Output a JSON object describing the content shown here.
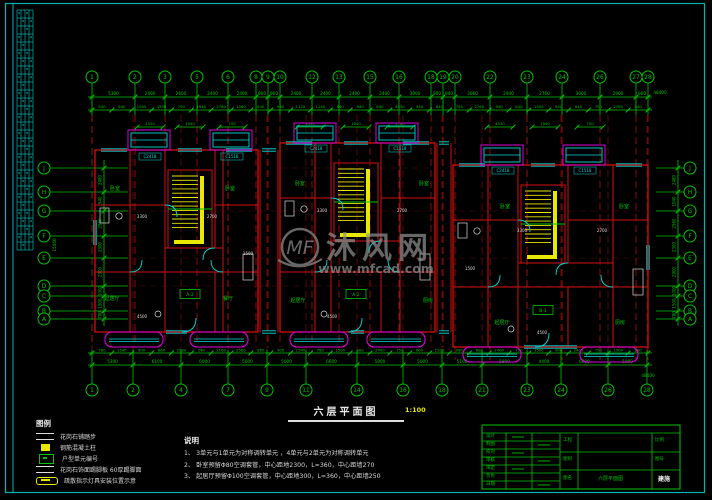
{
  "sheet": {
    "plan_title": "六层平面图",
    "plan_scale": "1:100"
  },
  "watermark": {
    "logo": "MF",
    "brand": "沐风网",
    "url": "www.mfcad.com"
  },
  "grid": {
    "top": [
      {
        "x": 92,
        "label": "1"
      },
      {
        "x": 135,
        "label": "2"
      },
      {
        "x": 165,
        "label": "3"
      },
      {
        "x": 197,
        "label": "5"
      },
      {
        "x": 228,
        "label": "6"
      },
      {
        "x": 256,
        "label": "8"
      },
      {
        "x": 268,
        "label": "9"
      },
      {
        "x": 280,
        "label": "10"
      },
      {
        "x": 312,
        "label": "12"
      },
      {
        "x": 339,
        "label": "13"
      },
      {
        "x": 370,
        "label": "15"
      },
      {
        "x": 399,
        "label": "16"
      },
      {
        "x": 431,
        "label": "18"
      },
      {
        "x": 443,
        "label": "19"
      },
      {
        "x": 455,
        "label": "20"
      },
      {
        "x": 490,
        "label": "22"
      },
      {
        "x": 527,
        "label": "23"
      },
      {
        "x": 562,
        "label": "24"
      },
      {
        "x": 600,
        "label": "26"
      },
      {
        "x": 636,
        "label": "27"
      },
      {
        "x": 648,
        "label": "28"
      }
    ],
    "bottom": [
      {
        "x": 92,
        "label": "1"
      },
      {
        "x": 133,
        "label": "2"
      },
      {
        "x": 181,
        "label": "4"
      },
      {
        "x": 228,
        "label": "7"
      },
      {
        "x": 267,
        "label": "9"
      },
      {
        "x": 306,
        "label": "11"
      },
      {
        "x": 357,
        "label": "14"
      },
      {
        "x": 403,
        "label": "16"
      },
      {
        "x": 442,
        "label": "18"
      },
      {
        "x": 482,
        "label": "21"
      },
      {
        "x": 527,
        "label": "23"
      },
      {
        "x": 561,
        "label": "24"
      },
      {
        "x": 608,
        "label": "26"
      },
      {
        "x": 647,
        "label": "28"
      }
    ],
    "left": [
      {
        "y": 168,
        "label": "J"
      },
      {
        "y": 192,
        "label": "H"
      },
      {
        "y": 211,
        "label": "G"
      },
      {
        "y": 236,
        "label": "F"
      },
      {
        "y": 258,
        "label": "E"
      },
      {
        "y": 286,
        "label": "D"
      },
      {
        "y": 296,
        "label": "C"
      },
      {
        "y": 311,
        "label": "B"
      },
      {
        "y": 319,
        "label": "A"
      }
    ],
    "right": [
      {
        "y": 168,
        "label": "J"
      },
      {
        "y": 192,
        "label": "H"
      },
      {
        "y": 211,
        "label": "G"
      },
      {
        "y": 236,
        "label": "F"
      },
      {
        "y": 258,
        "label": "E"
      },
      {
        "y": 286,
        "label": "D"
      },
      {
        "y": 296,
        "label": "C"
      },
      {
        "y": 311,
        "label": "B"
      },
      {
        "y": 319,
        "label": "A"
      }
    ]
  },
  "dims": {
    "top_row1": [
      "5300",
      "2400",
      "2600",
      "2400",
      "2400",
      "900",
      "900",
      "2400",
      "2400",
      "2400",
      "2400",
      "3000",
      "900",
      "940",
      "3060",
      "2940",
      "2760",
      "3000",
      "2900",
      "900"
    ],
    "top_row2": [
      "940",
      "640",
      "1500",
      "4530",
      "750",
      "1940",
      "2760",
      "1460",
      "640",
      "940",
      "1120",
      "1140",
      "640",
      "940",
      "640",
      "4530",
      "940",
      "640",
      "750",
      "2760",
      "940",
      "640",
      "1500",
      "940",
      "640",
      "750",
      "2760",
      "940"
    ],
    "top_total": "48400",
    "bottom_row1": [
      "780",
      "1540",
      "900",
      "860",
      "2580",
      "290",
      "2160",
      "2580",
      "860",
      "900",
      "1540",
      "780",
      "1500",
      "900",
      "2400",
      "750",
      "600",
      "1500",
      "980",
      "600",
      "2400",
      "750",
      "1500",
      "900",
      "2400",
      "750",
      "1500",
      "980"
    ],
    "bottom_row2": [
      "5300",
      "6100",
      "6000",
      "5000",
      "5000",
      "6600",
      "5900",
      "5000",
      "5100",
      "5800",
      "4400",
      "6000",
      "5000"
    ],
    "bottom_total": "48400",
    "left_chain": [
      "2480",
      "1940",
      "2560",
      "2300",
      "2900",
      "1000",
      "1500",
      "780"
    ],
    "right_chain": [
      "2480",
      "1940",
      "2560",
      "2300",
      "2900",
      "1000",
      "1500",
      "780"
    ],
    "left_total": "15460",
    "inner_row": [
      {
        "x": 150,
        "t": "4530"
      },
      {
        "x": 190,
        "t": "1940"
      },
      {
        "x": 232,
        "t": "750"
      },
      {
        "x": 310,
        "t": "4530"
      },
      {
        "x": 356,
        "t": "1940"
      },
      {
        "x": 400,
        "t": "2760"
      },
      {
        "x": 500,
        "t": "4530"
      },
      {
        "x": 545,
        "t": "1940"
      },
      {
        "x": 590,
        "t": "750"
      }
    ]
  },
  "plan": {
    "room_labels": [
      {
        "x": 115,
        "y": 190,
        "t": "卧室"
      },
      {
        "x": 230,
        "y": 190,
        "t": "卧室"
      },
      {
        "x": 112,
        "y": 300,
        "t": "起居厅"
      },
      {
        "x": 228,
        "y": 300,
        "t": "餐厅"
      },
      {
        "x": 300,
        "y": 185,
        "t": "卧室"
      },
      {
        "x": 424,
        "y": 185,
        "t": "卧室"
      },
      {
        "x": 298,
        "y": 302,
        "t": "起居厅"
      },
      {
        "x": 428,
        "y": 302,
        "t": "厨房"
      },
      {
        "x": 505,
        "y": 208,
        "t": "卧室"
      },
      {
        "x": 624,
        "y": 208,
        "t": "卧室"
      },
      {
        "x": 502,
        "y": 324,
        "t": "起居厅"
      },
      {
        "x": 620,
        "y": 324,
        "t": "厨房"
      }
    ],
    "white_dims": [
      {
        "x": 142,
        "y": 218,
        "t": "3300"
      },
      {
        "x": 212,
        "y": 218,
        "t": "2700"
      },
      {
        "x": 322,
        "y": 212,
        "t": "3300"
      },
      {
        "x": 402,
        "y": 212,
        "t": "2700"
      },
      {
        "x": 522,
        "y": 232,
        "t": "3300"
      },
      {
        "x": 602,
        "y": 232,
        "t": "2700"
      },
      {
        "x": 142,
        "y": 318,
        "t": "4500"
      },
      {
        "x": 332,
        "y": 318,
        "t": "4500"
      },
      {
        "x": 542,
        "y": 334,
        "t": "4500"
      },
      {
        "x": 248,
        "y": 255,
        "t": "1500"
      },
      {
        "x": 470,
        "y": 270,
        "t": "1500"
      }
    ],
    "unit_tags": [
      {
        "x": 190,
        "y": 296,
        "t": "A-2"
      },
      {
        "x": 356,
        "y": 296,
        "t": "A-2"
      },
      {
        "x": 543,
        "y": 312,
        "t": "B-1"
      }
    ],
    "window_tags": [
      {
        "x": 150,
        "y": 158,
        "t": "C2418"
      },
      {
        "x": 232,
        "y": 158,
        "t": "C1518"
      },
      {
        "x": 316,
        "y": 150,
        "t": "C2418"
      },
      {
        "x": 400,
        "y": 150,
        "t": "C1518"
      },
      {
        "x": 503,
        "y": 172,
        "t": "C2418"
      },
      {
        "x": 585,
        "y": 172,
        "t": "C1518"
      }
    ]
  },
  "legend": {
    "title": "图例",
    "items": [
      {
        "text": "花岗石铺踏步"
      },
      {
        "text": "钢筋混凝土柱"
      },
      {
        "text": "户型单元编号"
      },
      {
        "text": "花岗石饰面踢脚板 60厚踢脚面"
      },
      {
        "text": "疏散指示灯具安装位置示意"
      }
    ]
  },
  "notes": {
    "title": "说明",
    "lines": [
      "1、 3单元与1单元为对称调转单元 ，4单元与2单元为对称调转单元",
      "2、 卧室预留Φ80空调套管，中心距地2300，L=360，中心距墙270",
      "3、 起居厅预留Φ100空调套管，中心距地300，L=360，中心距墙250"
    ]
  },
  "titleblock": {
    "left_rows": [
      "设计",
      "制图",
      "校对",
      "审核",
      "审定",
      "负责",
      "日期"
    ],
    "mid_rows": [
      {
        "label": "工程",
        "value": ""
      },
      {
        "label": "图别",
        "value": ""
      },
      {
        "label": "图名",
        "value": "六层平面图"
      }
    ],
    "right_rows": [
      "比例",
      "图号"
    ],
    "stamp": "建施"
  },
  "colors": {
    "green": "#00c400",
    "red": "#cf1010",
    "cyan": "#00d8d8",
    "frame": "#00b4b4",
    "magenta": "#dd00dd",
    "yellow": "#e8e800",
    "white": "#d9d9d9",
    "gray": "#8f8f8f"
  }
}
